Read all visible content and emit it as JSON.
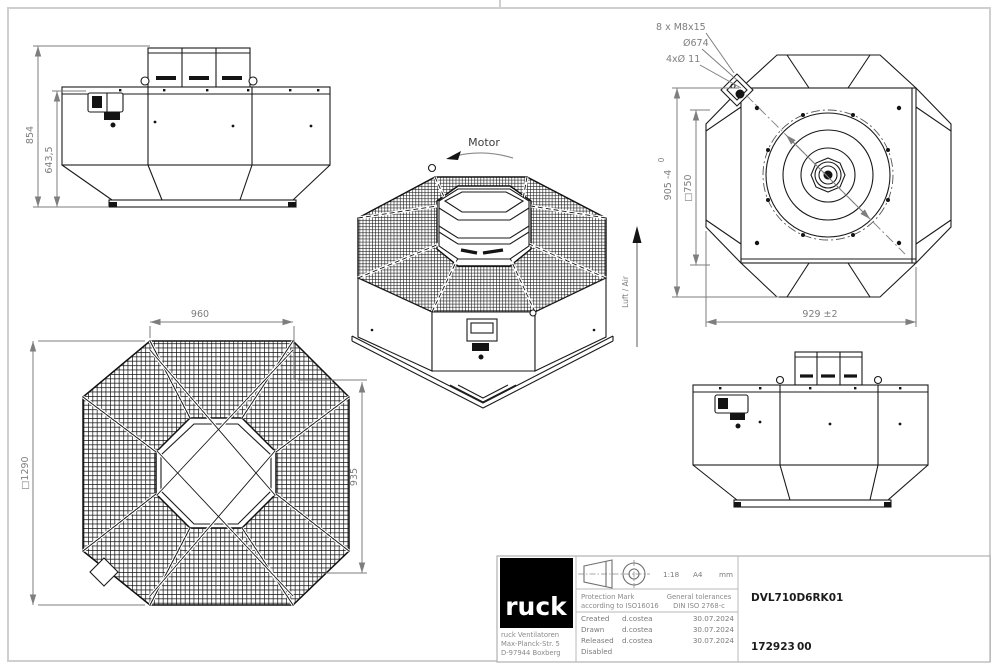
{
  "colors": {
    "line": "#1a1a1a",
    "dimension": "#7e7e7e",
    "frame": "#cfcfcf",
    "logo_bg": "#000000",
    "logo_text": "#ffffff"
  },
  "views": {
    "front": {
      "dim_total_height": "854",
      "dim_body_height": "643,5"
    },
    "iso": {
      "motor_label": "Motor",
      "air_label": "Luft / Air"
    },
    "bottom": {
      "note_bolts": "8 x M8x15",
      "note_bolt_circle": "Ø674",
      "note_holes": "4xØ 11",
      "dim_square": "905 -4",
      "dim_square_tol": "0",
      "dim_inner_square": "□750",
      "dim_width": "929 ±2"
    },
    "top": {
      "dim_width": "960",
      "dim_depth": "935",
      "dim_square": "□1290"
    }
  },
  "title_block": {
    "logo_text": "ruck",
    "address_line1": "ruck Ventilatoren",
    "address_line2": "Max-Planck-Str. 5",
    "address_line3": "D-97944 Boxberg",
    "scale": "1:18",
    "paper_size": "A4",
    "units": "mm",
    "protection_mark_line1": "Protection Mark",
    "protection_mark_line2": "according to ISO16016",
    "tolerances_line1": "General tolerances",
    "tolerances_line2": "DIN ISO 2768-c",
    "rows": [
      {
        "label": "Created",
        "name": "d.costea",
        "date": "30.07.2024"
      },
      {
        "label": "Drawn",
        "name": "d.costea",
        "date": "30.07.2024"
      },
      {
        "label": "Released",
        "name": "d.costea",
        "date": "30.07.2024"
      },
      {
        "label": "Disabled",
        "name": "",
        "date": ""
      }
    ],
    "part_number": "DVL710D6RK01",
    "drawing_number": "172923",
    "drawing_revision": "00"
  }
}
